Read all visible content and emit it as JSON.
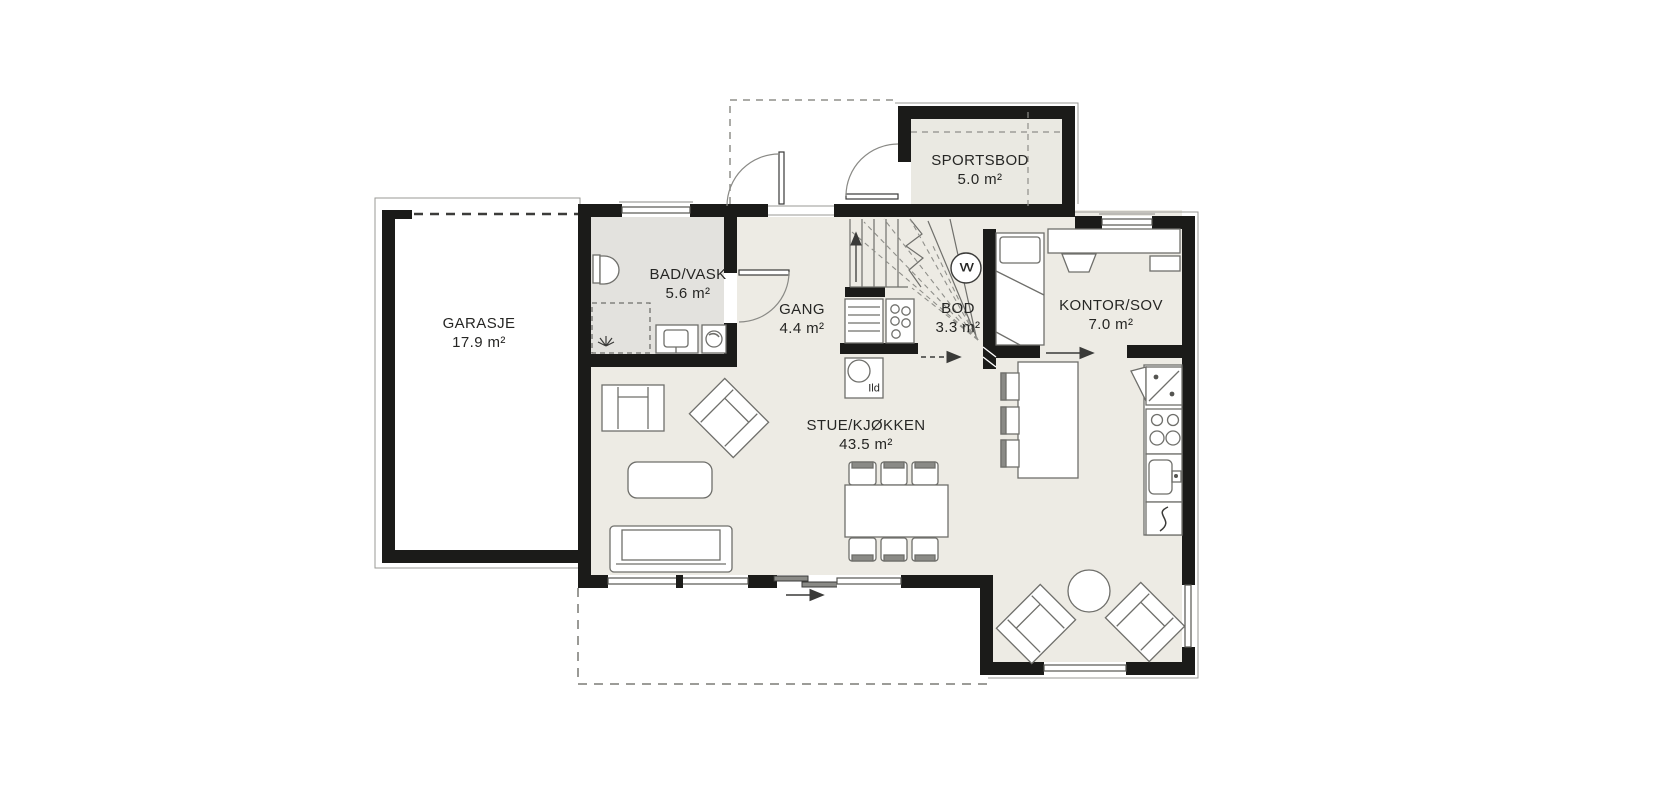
{
  "plan_title": "Floor plan - first floor",
  "rooms": [
    {
      "id": "garasje",
      "label": "GARASJE",
      "area": "17.9 m²"
    },
    {
      "id": "sportsbod",
      "label": "SPORTSBOD",
      "area": "5.0 m²"
    },
    {
      "id": "bad-vask",
      "label": "BAD/VASK",
      "area": "5.6 m²"
    },
    {
      "id": "gang",
      "label": "GANG",
      "area": "4.4 m²"
    },
    {
      "id": "bod",
      "label": "BOD",
      "area": "3.3 m²"
    },
    {
      "id": "kontor-sov",
      "label": "KONTOR/SOV",
      "area": "7.0 m²"
    },
    {
      "id": "stue-kjokken",
      "label": "STUE/KJØKKEN",
      "area": "43.5 m²"
    }
  ],
  "annotations": {
    "fireplace": "Ild",
    "water_heater": "VV"
  },
  "colors": {
    "wall": "#1b1b19",
    "floor": "#edebe4",
    "floor_bath": "#e3e2de",
    "floor_storage": "#eae9e2",
    "line": "#6f6f6b",
    "dash": "#8f8f8a"
  }
}
